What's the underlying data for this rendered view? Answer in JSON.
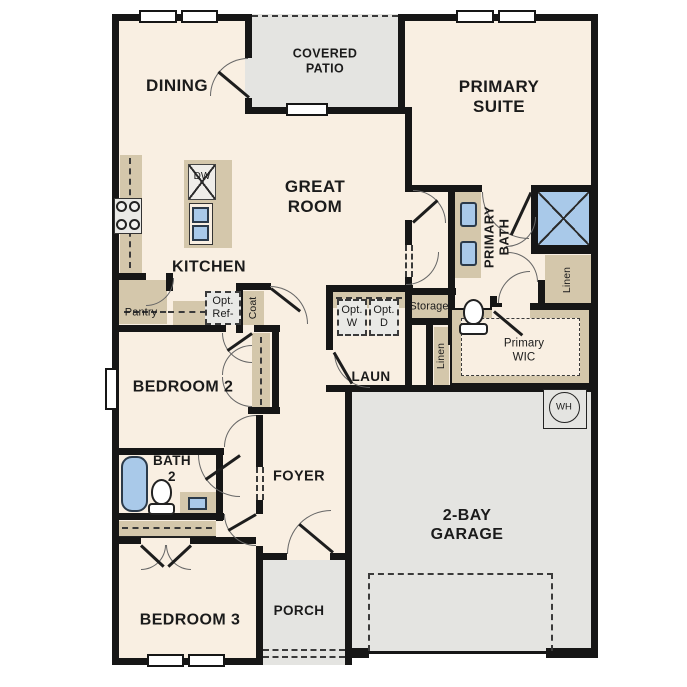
{
  "plan": {
    "title": "single-story home floor plan",
    "colors": {
      "wall": "#161616",
      "floor_interior": "#f9efe2",
      "floor_outdoor": "#e4e4e1",
      "cabinet_tan": "#d4c7ab",
      "fixture_blue": "#a9c9e9",
      "appliance_gray": "#e9e9e6",
      "dash": "#3a3a3a"
    },
    "labels": {
      "dining": "DINING",
      "covered_patio": "COVERED\nPATIO",
      "primary_suite": "PRIMARY\nSUITE",
      "great_room": "GREAT\nROOM",
      "kitchen": "KITCHEN",
      "pantry": "Pantry",
      "opt_ref": "Opt.\nRef-",
      "coat": "Coat",
      "opt_w": "Opt.\nW",
      "opt_d": "Opt.\nD",
      "storage": "Storage",
      "linen_hall": "Linen",
      "laundry": "LAUN",
      "primary_bath": "PRIMARY\nBATH",
      "linen_bath": "Linen",
      "primary_wic": "Primary\nWIC",
      "bedroom_2": "BEDROOM 2",
      "bath_2": "BATH\n2",
      "foyer": "FOYER",
      "bedroom_3": "BEDROOM 3",
      "porch": "PORCH",
      "garage": "2-BAY\nGARAGE",
      "water_heater": "WH",
      "dishwasher": "DW"
    }
  }
}
